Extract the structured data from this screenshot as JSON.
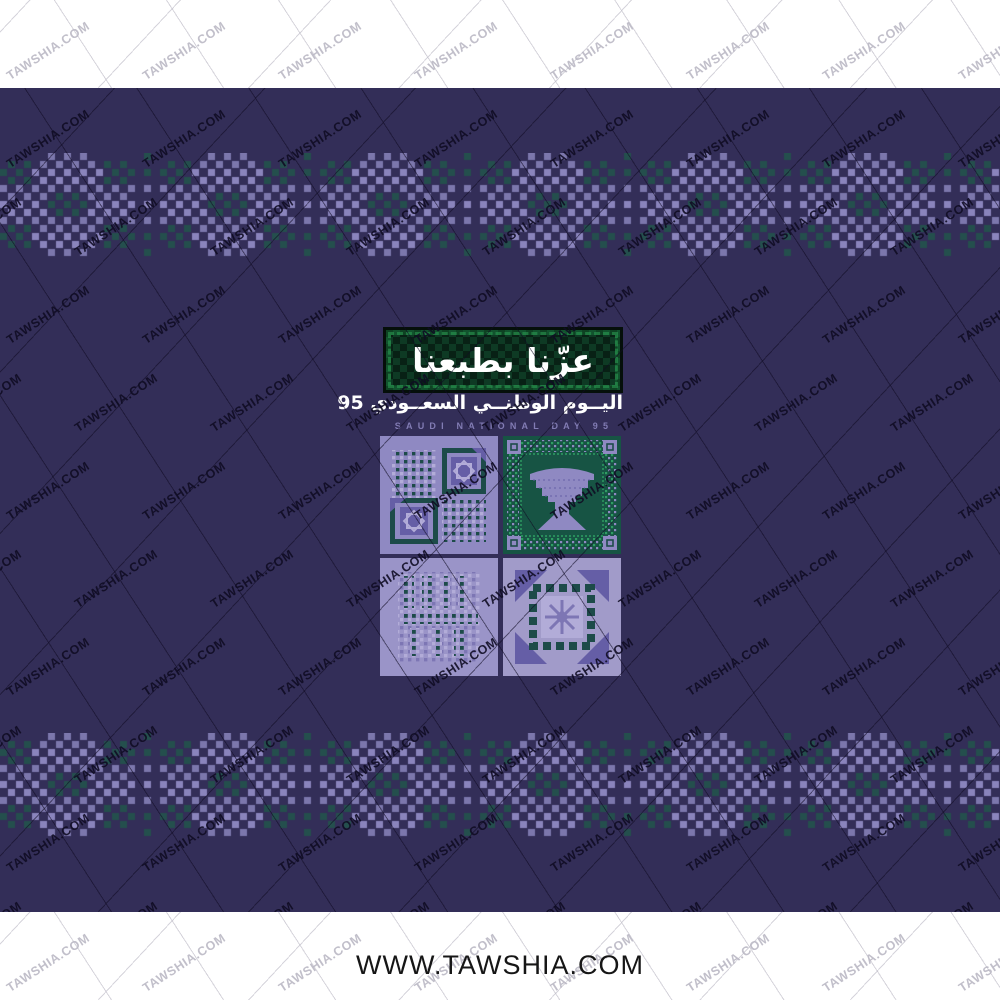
{
  "site": {
    "watermark": "TAWSHIA.COM",
    "footer_url": "WWW.TAWSHIA.COM"
  },
  "artwork": {
    "slogan_ar": "عزّنا بطبعنا",
    "title_ar": "اليــوم الوطنــي السعــودي 95",
    "title_en": "SAUDI NATIONAL DAY 95",
    "panel_names": [
      "sadu-dot-medallion-tile",
      "green-vase-ornament-tile",
      "sadu-dot-grid-tile",
      "star-sawtooth-tile"
    ]
  },
  "palette": {
    "navy": "#332e58",
    "lavender": "#8f89c2",
    "lavender_light": "#b2acd8",
    "teal": "#24514d",
    "teal_dot": "#1d4b49",
    "panel_green": "#175444",
    "green_bright": "#2f9e63",
    "banner_green_dark": "#0e3a24",
    "banner_green_darker": "#082115",
    "purple_deep": "#655ea6",
    "purple_mid": "#7d76b4",
    "white": "#ffffff",
    "watermark_dark": "rgba(16,12,36,0.9)",
    "watermark_light": "rgba(186,184,196,0.9)"
  }
}
